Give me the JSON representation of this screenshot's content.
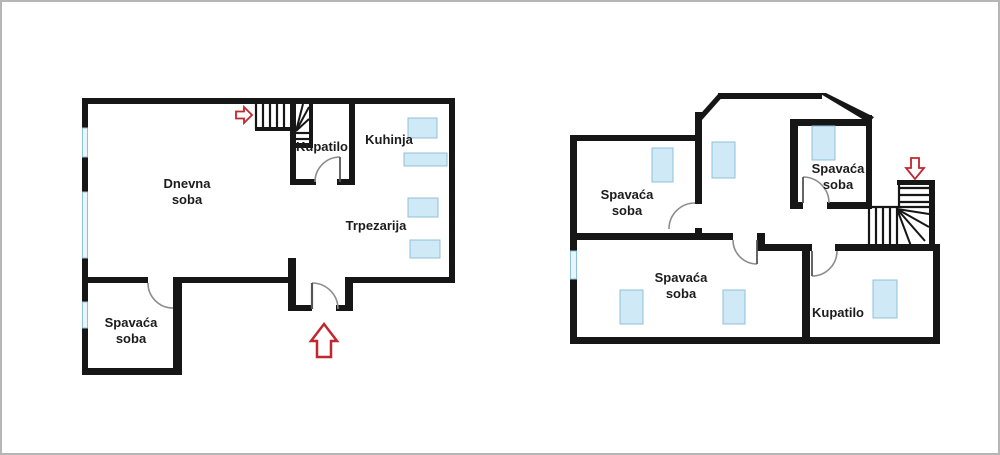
{
  "colors": {
    "wall": "#161616",
    "window_fill": "#cfe9f7",
    "window_border": "#8fc0da",
    "door_arc": "#8c8c8c",
    "door_leaf": "#555555",
    "arrow_red": "#c0272e",
    "label_text": "#1c1c1c",
    "frame_border": "#b6b6b6"
  },
  "floors": {
    "ground": {
      "rooms": [
        {
          "label": "Dnevna soba"
        },
        {
          "label": "Kupatilo"
        },
        {
          "label": "Kuhinja"
        },
        {
          "label": "Trpezarija"
        },
        {
          "label": "Spavaća soba"
        }
      ]
    },
    "upper": {
      "rooms": [
        {
          "label": "Spavaća soba"
        },
        {
          "label": "Spavaća soba"
        },
        {
          "label": "Spavaća soba"
        },
        {
          "label": "Kupatilo"
        }
      ]
    }
  },
  "icons": {
    "ground_stairs_arrow": "right-arrow",
    "entrance_arrow": "up-arrow",
    "upper_stairs_arrow": "down-arrow"
  }
}
